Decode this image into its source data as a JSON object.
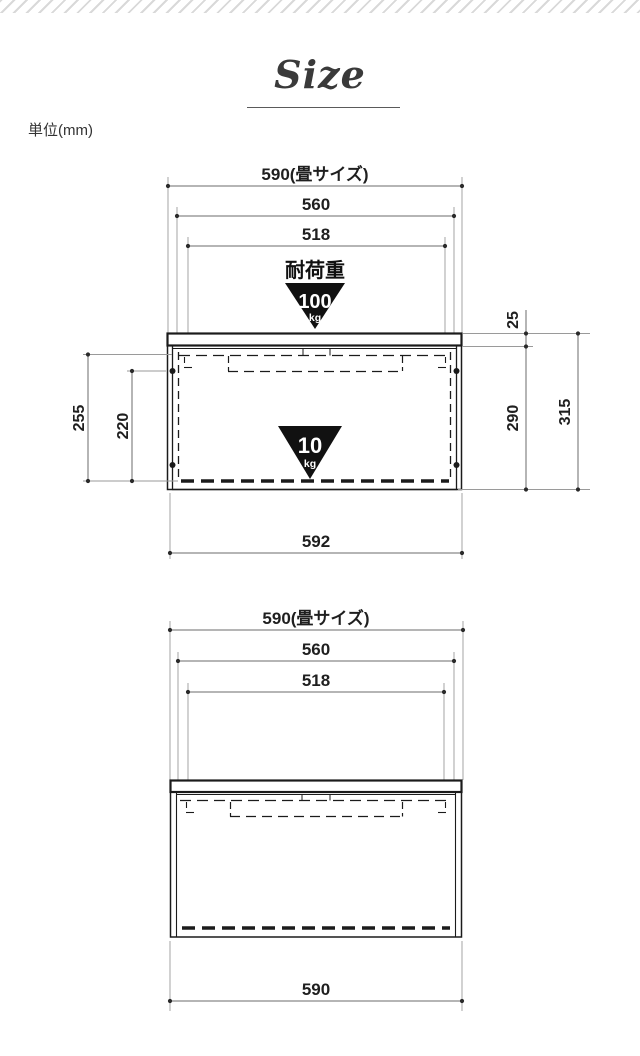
{
  "header": {
    "title": "Size",
    "unit_label": "単位(mm)"
  },
  "colors": {
    "outline": "#1b1b1b",
    "dimension_line": "#6b6b6b",
    "extension_line": "#9a9a9a",
    "text": "#1f1f1f",
    "triangle_fill": "#111111",
    "hatch_stripe": "#d9d9d9"
  },
  "front_view": {
    "dims": {
      "width_top": "590(畳サイズ)",
      "width_mid": "560",
      "width_inner": "518",
      "width_bottom": "592",
      "left_outer": "255",
      "left_inner": "220",
      "right_top": "25",
      "right_mid": "290",
      "right_total": "315"
    },
    "load": {
      "heading": "耐荷重",
      "total_value": "100",
      "total_unit": "kg",
      "shelf_value": "10",
      "shelf_unit": "kg"
    }
  },
  "back_view": {
    "dims": {
      "width_top": "590(畳サイズ)",
      "width_mid": "560",
      "width_inner": "518",
      "width_bottom": "590"
    }
  }
}
